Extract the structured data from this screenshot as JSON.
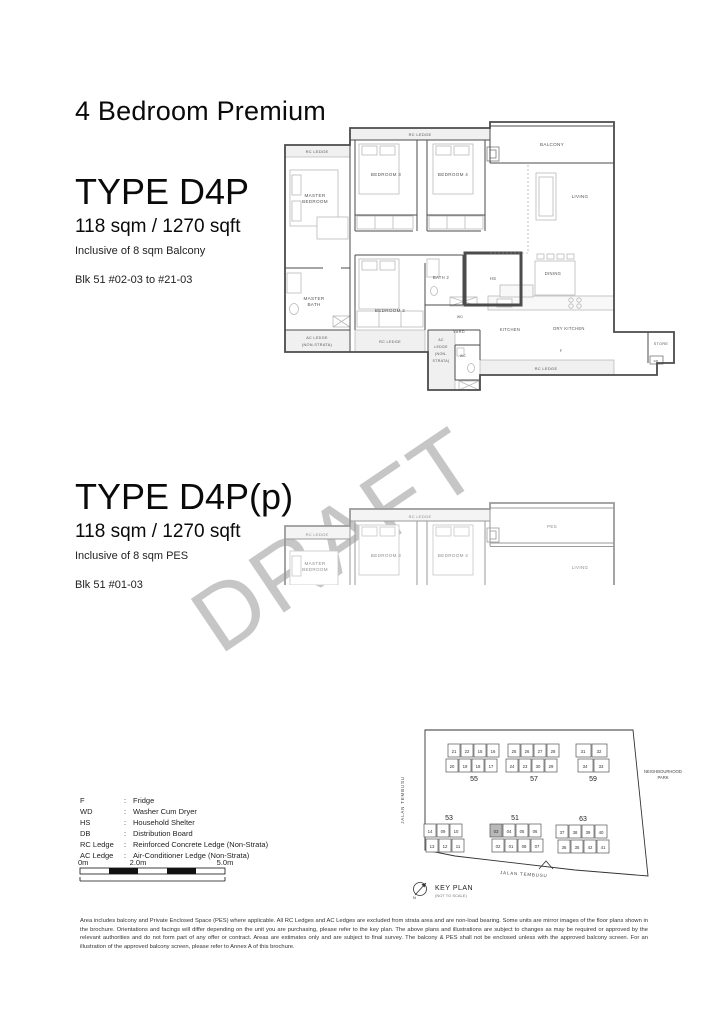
{
  "page": {
    "title": "4 Bedroom Premium",
    "watermark": "DRAFT"
  },
  "types": {
    "d4p": {
      "name": "TYPE D4P",
      "area": "118 sqm / 1270 sqft",
      "inclusive": "Inclusive of 8 sqm Balcony",
      "blocks": "Blk 51 #02-03 to #21-03"
    },
    "d4pp": {
      "name": "TYPE D4P(p)",
      "area": "118 sqm / 1270 sqft",
      "inclusive": "Inclusive of 8 sqm PES",
      "blocks": "Blk 51 #01-03"
    }
  },
  "rooms": {
    "rc_ledge": "RC LEDGE",
    "ac_ledge_1": "AC LEDGE",
    "ac_ledge_2": "(NON-STRATA)",
    "ac_mid_1": "AC",
    "ac_mid_2": "LEDGE",
    "ac_mid_3": "(NON-",
    "ac_mid_4": "STRATA)",
    "master_1": "MASTER",
    "master_2": "BEDROOM",
    "master_bath_1": "MASTER",
    "master_bath_2": "BATH",
    "bedroom2": "BEDROOM 2",
    "bedroom3": "BEDROOM 3",
    "bedroom4": "BEDROOM 4",
    "balcony": "BALCONY",
    "pes": "PES",
    "living": "LIVING",
    "dining": "DINING",
    "bath2": "BATH 2",
    "hs": "HS",
    "wd": "WD",
    "yard": "YARD",
    "kitchen": "KITCHEN",
    "dry_kitchen": "DRY KITCHEN",
    "wc": "WC",
    "fridge": "F",
    "store": "STORE",
    "db": "DB"
  },
  "legend": {
    "separator": ":",
    "rows": [
      {
        "term": "F",
        "def": "Fridge"
      },
      {
        "term": "WD",
        "def": "Washer Cum Dryer"
      },
      {
        "term": "HS",
        "def": "Household Shelter"
      },
      {
        "term": "DB",
        "def": "Distribution Board"
      },
      {
        "term": "RC Ledge",
        "def": "Reinforced Concrete Ledge (Non-Strata)"
      },
      {
        "term": "AC Ledge",
        "def": "Air-Conditioner Ledge (Non-Strata)"
      }
    ]
  },
  "scalebar": {
    "labels": [
      "0m",
      "2.0m",
      "5.0m"
    ]
  },
  "keyplan": {
    "title": "KEY PLAN",
    "subtitle": "(NOT TO SCALE)",
    "north": "N",
    "road_left": "JALAN TEMBUSU",
    "road_bottom": "JALAN TEMBUSU",
    "park_1": "NEIGHBOURHOOD",
    "park_2": "PARK",
    "highlight_unit": "03",
    "blocks": [
      {
        "number": "55",
        "row1": [
          "21",
          "22",
          "15",
          "16"
        ],
        "row2": [
          "20",
          "19",
          "18",
          "17"
        ]
      },
      {
        "number": "57",
        "row1": [
          "25",
          "26",
          "27",
          "28"
        ],
        "row2": [
          "24",
          "23",
          "30",
          "29"
        ]
      },
      {
        "number": "59",
        "row1": [
          "31",
          "32"
        ],
        "row2": [
          "34",
          "33"
        ]
      },
      {
        "number": "53",
        "row1": [
          "14",
          "09",
          "10"
        ],
        "row2": [
          "13",
          "12",
          "11"
        ]
      },
      {
        "number": "51",
        "row1": [
          "03",
          "04",
          "05",
          "06"
        ],
        "row2": [
          "02",
          "01",
          "08",
          "07"
        ]
      },
      {
        "number": "63",
        "row1": [
          "37",
          "38",
          "39",
          "40"
        ],
        "row2": [
          "36",
          "35",
          "42",
          "41"
        ]
      }
    ]
  },
  "disclaimer": "Area includes balcony and Private Enclosed Space (PES) where applicable. All RC Ledges and AC Ledges are excluded from strata area and are non-load bearing. Some units are mirror images of the floor plans shown in the brochure. Orientations and facings will differ depending on the unit you are purchasing, please refer to the key plan. The above plans and illustrations are subject to changes as may be required or approved by the relevant authorities and do not form part of any offer or contract. Areas are estimates only and are subject to final survey. The balcony & PES shall not be enclosed unless with the approved balcony screen. For an illustration of the approved balcony screen, please refer to Annex A of this brochure."
}
